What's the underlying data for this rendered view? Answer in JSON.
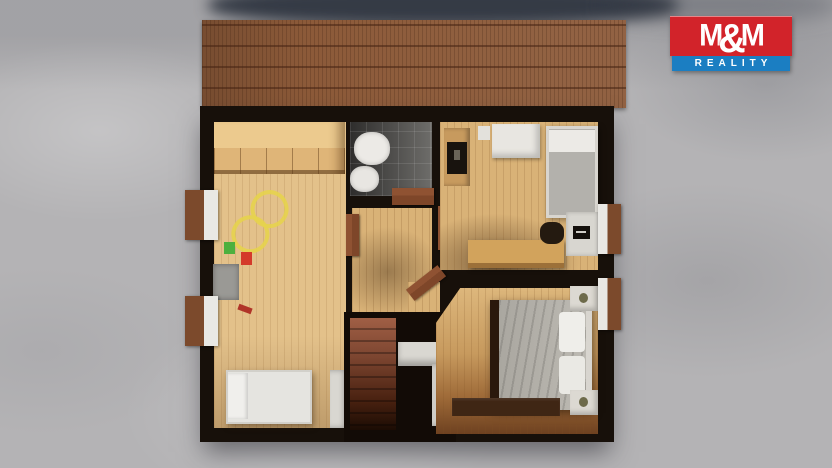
{
  "watermark": {
    "brand_m1": "M",
    "brand_amp": "&",
    "brand_m2": "M",
    "tagline": "REALITY",
    "brand_bg": "#d2232a",
    "tagline_bg": "#1b7ec2",
    "text_color": "#ffffff"
  },
  "scene": {
    "type": "3d-floorplan-top-down-render",
    "setting": "floor-plan model standing on a mottled light-gray snowy ground with cast shadow",
    "roof": "brown tiled roof strip across the top of the model",
    "colors": {
      "ground": "#b4b3b5",
      "roof": "#8c5a39",
      "walls": "#17100a",
      "wood_floor": "#d9b277",
      "children_floor": "#e3c18a",
      "bathroom_tile": "#4a4948",
      "stair_carpet": "#8a4f38",
      "bed_linen": "#e5e4e0",
      "duvet_gray": "#b2afa8",
      "door_wood": "#7e4629",
      "toy_track_yellow": "#e6d34c",
      "window_frame": "#7c4a2c"
    },
    "rooms": [
      {
        "name": "children-room",
        "furniture": [
          "wardrobe",
          "toy-race-track",
          "toy-box",
          "toy-blocks",
          "single-bed"
        ],
        "windows": 2
      },
      {
        "name": "bathroom",
        "furniture": [
          "toilet",
          "bidet"
        ],
        "windows": 0
      },
      {
        "name": "hallway",
        "furniture": [
          "staircase",
          "stair-parapet",
          "open-doors"
        ],
        "windows": 0
      },
      {
        "name": "study-bedroom",
        "furniture": [
          "tv-cabinet",
          "storage-boxes",
          "single-bed",
          "wooden-table",
          "office-chair",
          "desk-with-laptop"
        ],
        "windows": 1
      },
      {
        "name": "master-bedroom",
        "furniture": [
          "double-bed",
          "nightstand-top",
          "nightstand-bottom",
          "dresser"
        ],
        "windows": 1
      }
    ],
    "window_count": 4
  }
}
